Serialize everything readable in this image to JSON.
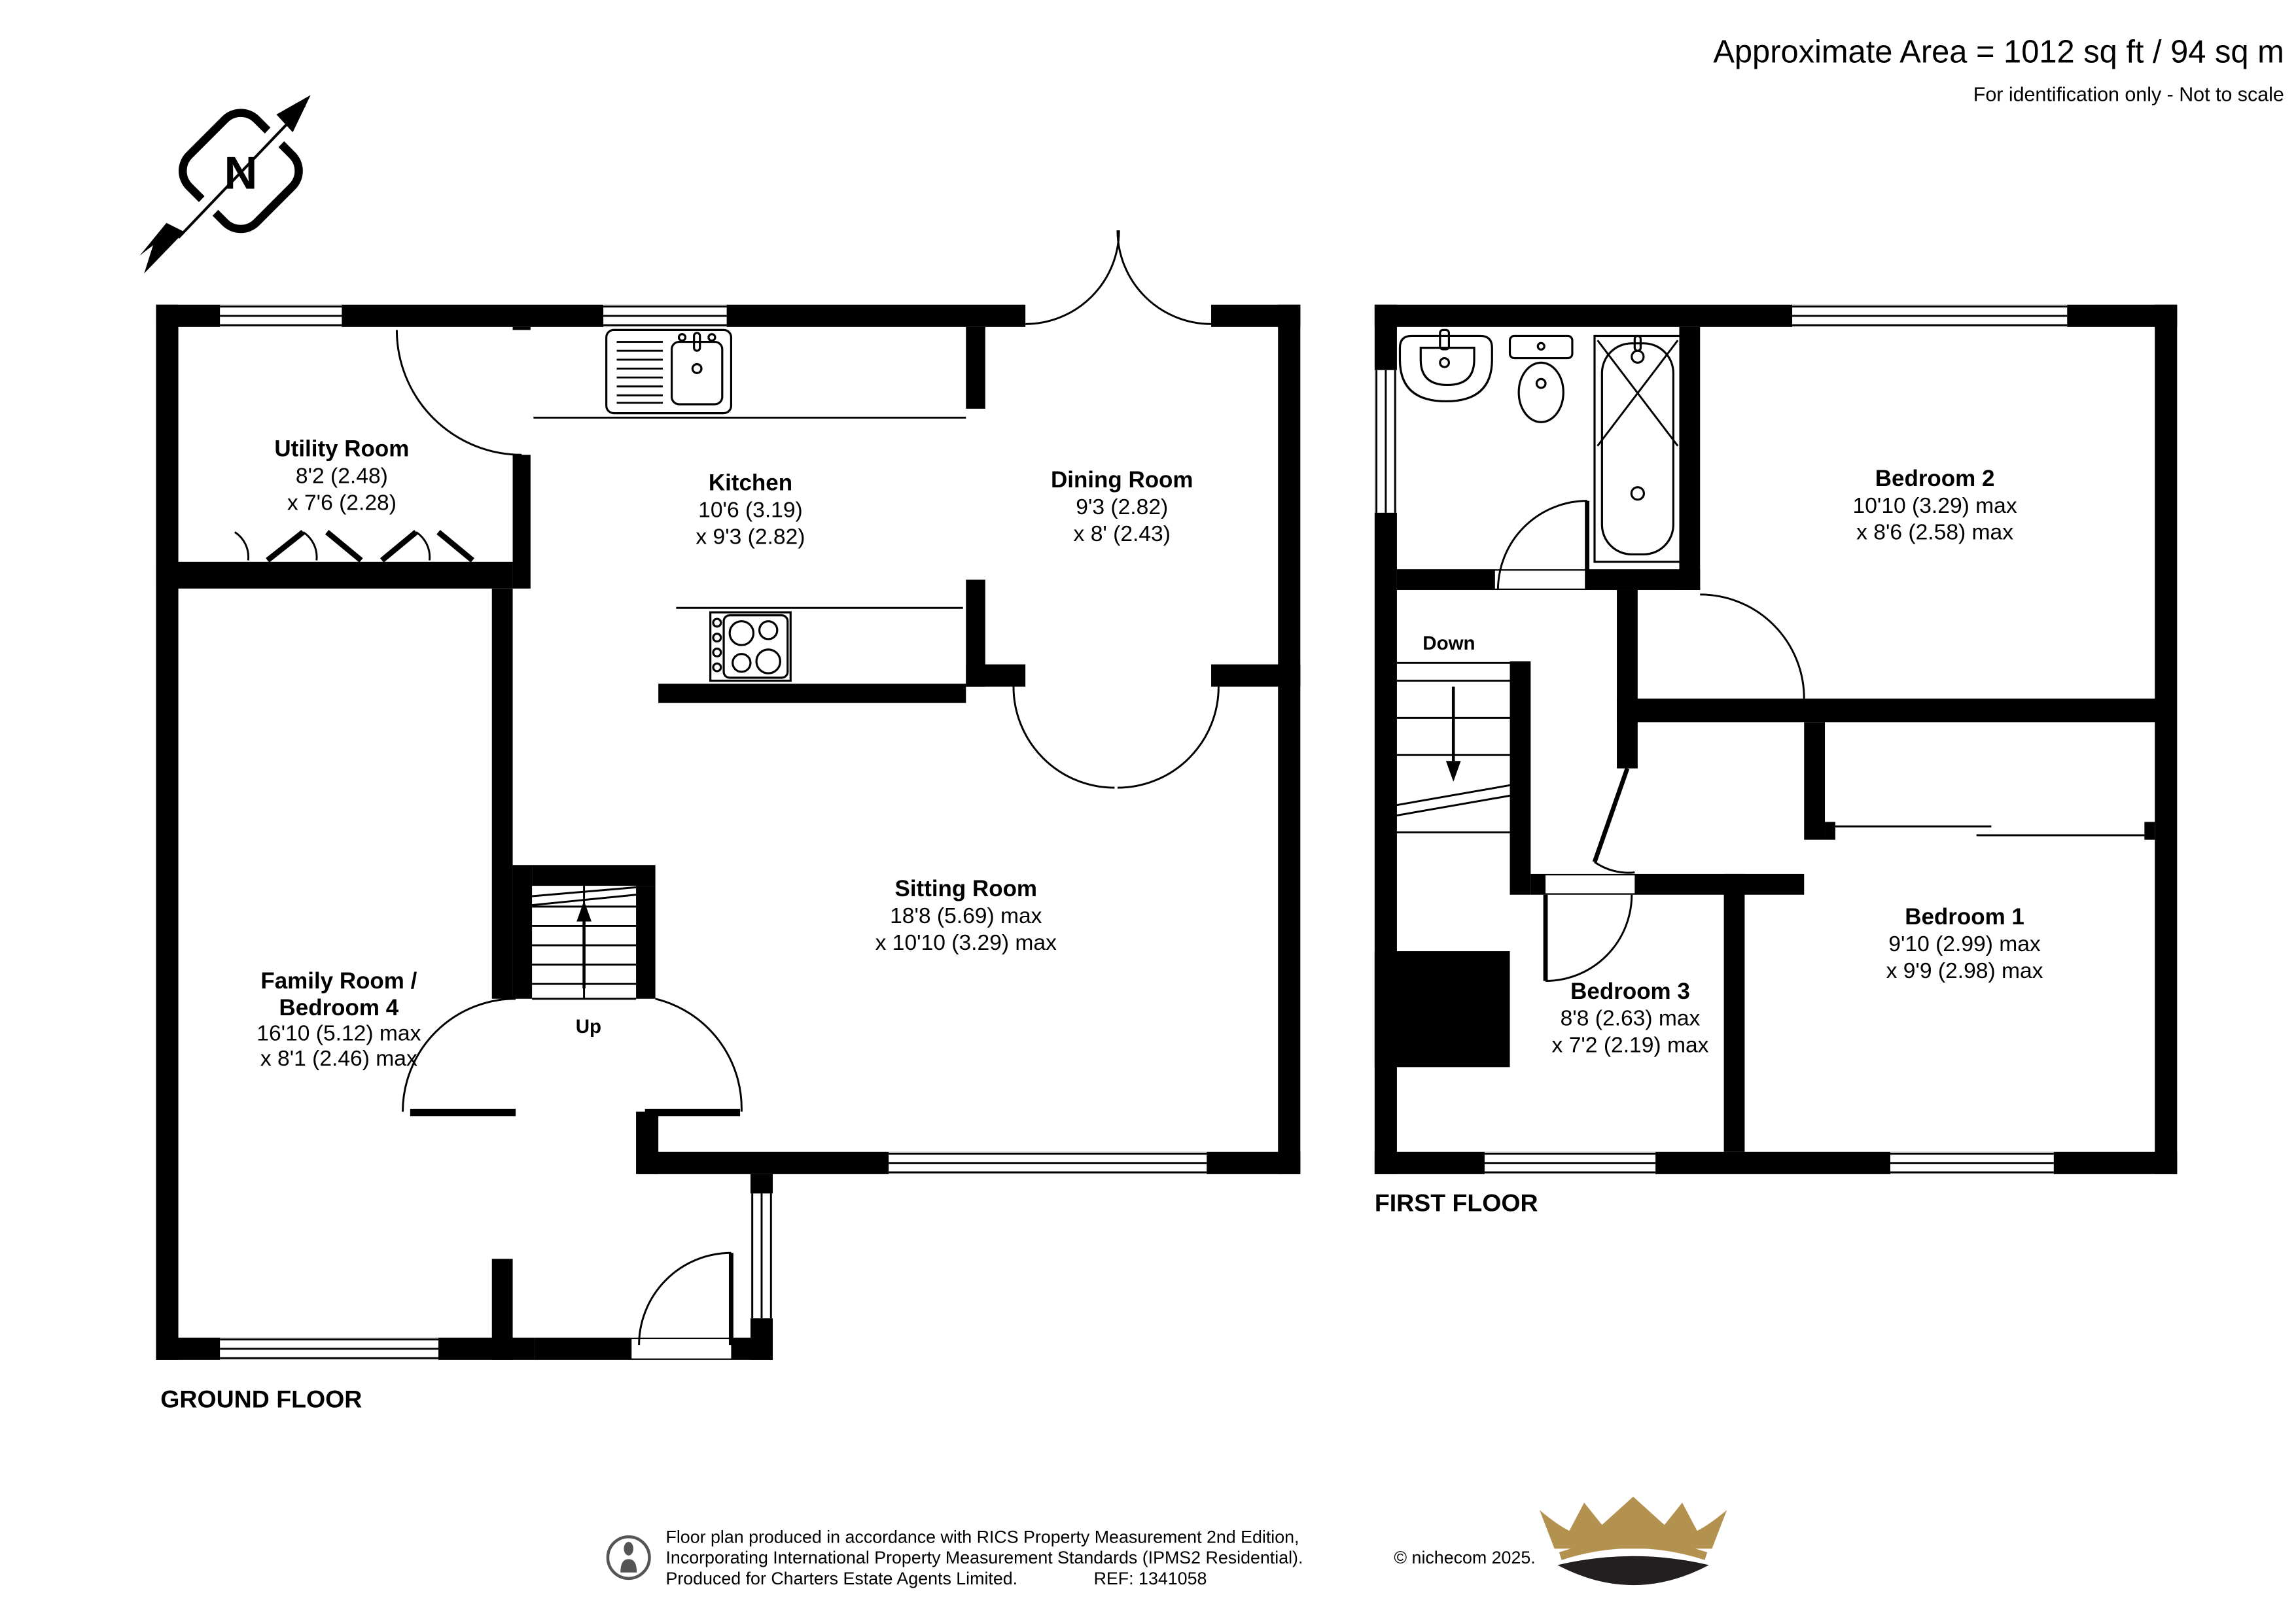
{
  "header": {
    "area_line": "Approximate Area = 1012 sq ft / 94 sq m",
    "scale_note": "For identification only - Not to scale"
  },
  "floors": {
    "ground": {
      "title": "GROUND FLOOR"
    },
    "first": {
      "title": "FIRST FLOOR"
    }
  },
  "compass": {
    "label": "N"
  },
  "stairs": {
    "up_label": "Up",
    "down_label": "Down"
  },
  "rooms": {
    "utility": {
      "name": "Utility Room",
      "dim1": "8'2 (2.48)",
      "dim2": "x 7'6 (2.28)"
    },
    "kitchen": {
      "name": "Kitchen",
      "dim1": "10'6 (3.19)",
      "dim2": "x 9'3 (2.82)"
    },
    "dining": {
      "name": "Dining Room",
      "dim1": "9'3 (2.82)",
      "dim2": "x 8' (2.43)"
    },
    "sitting": {
      "name": "Sitting Room",
      "dim1": "18'8 (5.69) max",
      "dim2": "x 10'10 (3.29) max"
    },
    "family": {
      "name_line1": "Family Room /",
      "name_line2": "Bedroom 4",
      "dim1": "16'10 (5.12) max",
      "dim2": "x 8'1 (2.46) max"
    },
    "bedroom1": {
      "name": "Bedroom 1",
      "dim1": "9'10 (2.99) max",
      "dim2": "x 9'9 (2.98) max"
    },
    "bedroom2": {
      "name": "Bedroom 2",
      "dim1": "10'10 (3.29) max",
      "dim2": "x 8'6 (2.58) max"
    },
    "bedroom3": {
      "name": "Bedroom 3",
      "dim1": "8'8 (2.63) max",
      "dim2": "x 7'2 (2.19) max"
    }
  },
  "footer": {
    "line1": "Floor plan produced in accordance with RICS Property Measurement 2nd Edition,",
    "line2": "Incorporating International Property Measurement Standards (IPMS2 Residential).",
    "line3": "Produced for Charters Estate Agents Limited.",
    "ref": "REF: 1341058",
    "copyright": "© nichecom 2025."
  },
  "icons": {
    "compass": "north-compass-icon",
    "agent_mark": "person-badge-icon",
    "logo": "charters-crown-logo"
  },
  "colors": {
    "walls": "#000000",
    "footer_text": "#6d6d6d",
    "crown_gold": "#b3924f",
    "crown_dark": "#231f20"
  }
}
